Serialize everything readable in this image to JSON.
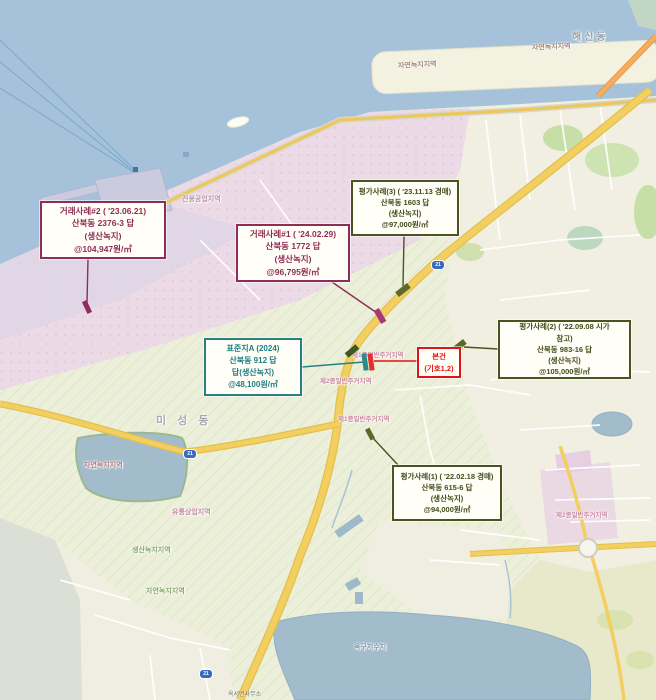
{
  "map": {
    "callouts": [
      {
        "id": "tx-case-2",
        "x": 40,
        "y": 201,
        "w": 126,
        "h": 58,
        "border": "#8e2d55",
        "color": "#8e2d55",
        "size": 8.5,
        "lines": [
          "거래사례#2 ( '23.06.21)",
          "산북동 2376-3 답",
          "(생산녹지)",
          "@104,947원/㎡"
        ],
        "leader": {
          "x1": 88,
          "y1": 259,
          "x2": 87,
          "y2": 303
        },
        "marker": {
          "x": 87,
          "y": 307,
          "w": 5,
          "h": 13,
          "rot": -25,
          "fill": "#8e2d55"
        }
      },
      {
        "id": "tx-case-1",
        "x": 236,
        "y": 224,
        "w": 114,
        "h": 58,
        "border": "#8e2d55",
        "color": "#8e2d55",
        "size": 8.5,
        "lines": [
          "거래사례#1 ( '24.02.29)",
          "산북동 1772 답",
          "(생산녹지)",
          "@96,795원/㎡"
        ],
        "leader": {
          "x1": 332,
          "y1": 282,
          "x2": 377,
          "y2": 313
        },
        "marker": {
          "x": 380,
          "y": 316,
          "w": 6,
          "h": 15,
          "rot": -30,
          "fill": "#a8387c"
        }
      },
      {
        "id": "appraisal-case-3",
        "x": 351,
        "y": 180,
        "w": 108,
        "h": 56,
        "border": "#4a5420",
        "color": "#434d1c",
        "size": 7.5,
        "lines": [
          "평가사례(3) ( '23.11.13 경매)",
          "산북동 1603 답",
          "(생산녹지)",
          "@97,000원/㎡"
        ],
        "leader": {
          "x1": 404,
          "y1": 236,
          "x2": 403,
          "y2": 286
        },
        "marker": {
          "x": 403,
          "y": 290,
          "w": 15,
          "h": 6,
          "rot": -38,
          "fill": "#5a6a2a"
        }
      },
      {
        "id": "appraisal-case-2",
        "x": 498,
        "y": 320,
        "w": 133,
        "h": 59,
        "border": "#4a5420",
        "color": "#434d1c",
        "size": 7.5,
        "lines": [
          "평가사례(2) ( '22.09.08 시가",
          "참고)",
          "산북동 983-16 답",
          "(생산녹지)",
          "@105,000원/㎡"
        ],
        "leader": {
          "x1": 498,
          "y1": 349,
          "x2": 464,
          "y2": 347
        },
        "marker": {
          "x": 459,
          "y": 346,
          "w": 15,
          "h": 6,
          "rot": -38,
          "fill": "#5a6a2a"
        }
      },
      {
        "id": "standard-lot-A",
        "x": 204,
        "y": 338,
        "w": 98,
        "h": 58,
        "border": "#2a7f85",
        "color": "#1f7d84",
        "size": 8,
        "lines": [
          "표준지A (2024)",
          "산북동 912 답",
          "답(생산녹지)",
          "@48,100원/㎡"
        ],
        "leader": {
          "x1": 302,
          "y1": 367,
          "x2": 364,
          "y2": 362
        },
        "marker": {
          "x": 365,
          "y": 362,
          "w": 5,
          "h": 17,
          "rot": -8,
          "fill": "#2a8a8a"
        }
      },
      {
        "id": "subject-property",
        "x": 417,
        "y": 347,
        "w": 44,
        "h": 31,
        "border": "#e01414",
        "color": "#e01414",
        "size": 7.5,
        "lines": [
          "본건",
          "(기호1,2)"
        ],
        "leader": {
          "x1": 417,
          "y1": 361,
          "x2": 374,
          "y2": 361
        },
        "marker": {
          "x": 371,
          "y": 362,
          "w": 5,
          "h": 17,
          "rot": -8,
          "fill": "#e03030"
        }
      },
      {
        "id": "appraisal-case-1",
        "x": 392,
        "y": 465,
        "w": 110,
        "h": 56,
        "border": "#4a5420",
        "color": "#434d1c",
        "size": 7.5,
        "lines": [
          "평가사례(1) ( '22.02.18 경매)",
          "산북동 615-6 답",
          "(생산녹지)",
          "@94,000원/㎡"
        ],
        "leader": {
          "x1": 398,
          "y1": 465,
          "x2": 372,
          "y2": 437
        },
        "marker": {
          "x": 370,
          "y": 434,
          "w": 5,
          "h": 12,
          "rot": -28,
          "fill": "#5a6a2a"
        }
      }
    ],
    "extra_markers": [
      {
        "x": 352,
        "y": 351,
        "w": 14,
        "h": 6,
        "rot": -40,
        "fill": "#3a5a28"
      }
    ],
    "labels": [
      {
        "name": "zone-label-natural-green-breakwater-1",
        "text": "자연녹지지역",
        "x": 398,
        "y": 60,
        "color": "#a08878",
        "size": 7,
        "rotate": -3
      },
      {
        "name": "zone-label-natural-green-breakwater-2",
        "text": "자연녹지지역",
        "x": 532,
        "y": 42,
        "color": "#a08878",
        "size": 7,
        "rotate": -3
      },
      {
        "name": "district-label-haesin-dong",
        "text": "해신동",
        "x": 572,
        "y": 28,
        "color": "#98a0aa",
        "size": 10,
        "spacing": 3
      },
      {
        "name": "zone-label-exclusive-industrial",
        "text": "전용공업지역",
        "x": 182,
        "y": 194,
        "color": "#b892a8",
        "size": 7
      },
      {
        "name": "zone-label-natural-green-reservoir",
        "text": "자연녹지지역",
        "x": 84,
        "y": 460,
        "color": "#b87878",
        "size": 7
      },
      {
        "name": "zone-label-distribution-commercial",
        "text": "유통상업지역",
        "x": 172,
        "y": 507,
        "color": "#c488a8",
        "size": 7
      },
      {
        "name": "zone-label-production-green",
        "text": "생산녹지지역",
        "x": 132,
        "y": 545,
        "color": "#88a868",
        "size": 7
      },
      {
        "name": "zone-label-natural-green-southwest",
        "text": "자연녹지지역",
        "x": 146,
        "y": 586,
        "color": "#88a868",
        "size": 7
      },
      {
        "name": "zone-label-residential-1a",
        "text": "제1종일반주거지역",
        "x": 352,
        "y": 349,
        "color": "#c88aa0",
        "size": 6.5
      },
      {
        "name": "zone-label-residential-2a",
        "text": "제2종일반주거지역",
        "x": 320,
        "y": 375,
        "color": "#c88aa0",
        "size": 6.5
      },
      {
        "name": "zone-label-residential-1b",
        "text": "제1종일반주거지역",
        "x": 338,
        "y": 413,
        "color": "#c88aa0",
        "size": 6.5
      },
      {
        "name": "zone-label-residential-2b",
        "text": "제2종일반주거지역",
        "x": 556,
        "y": 509,
        "color": "#c88aa0",
        "size": 6.5
      },
      {
        "name": "lake-label-okgu-reservoir",
        "text": "옥구저수지",
        "x": 354,
        "y": 642,
        "color": "#8098b0",
        "size": 7
      },
      {
        "name": "district-label-miseong-dong",
        "text": "미 성 동",
        "x": 156,
        "y": 412,
        "color": "#a6a8ae",
        "size": 11,
        "spacing": 4
      },
      {
        "name": "poi-label-okseo-office",
        "text": "옥서면사무소",
        "x": 228,
        "y": 689,
        "color": "#707880",
        "size": 6
      }
    ],
    "route_shields": [
      {
        "x": 183,
        "y": 449,
        "label": "21"
      },
      {
        "x": 431,
        "y": 260,
        "label": "21"
      },
      {
        "x": 199,
        "y": 669,
        "label": "21"
      }
    ]
  }
}
